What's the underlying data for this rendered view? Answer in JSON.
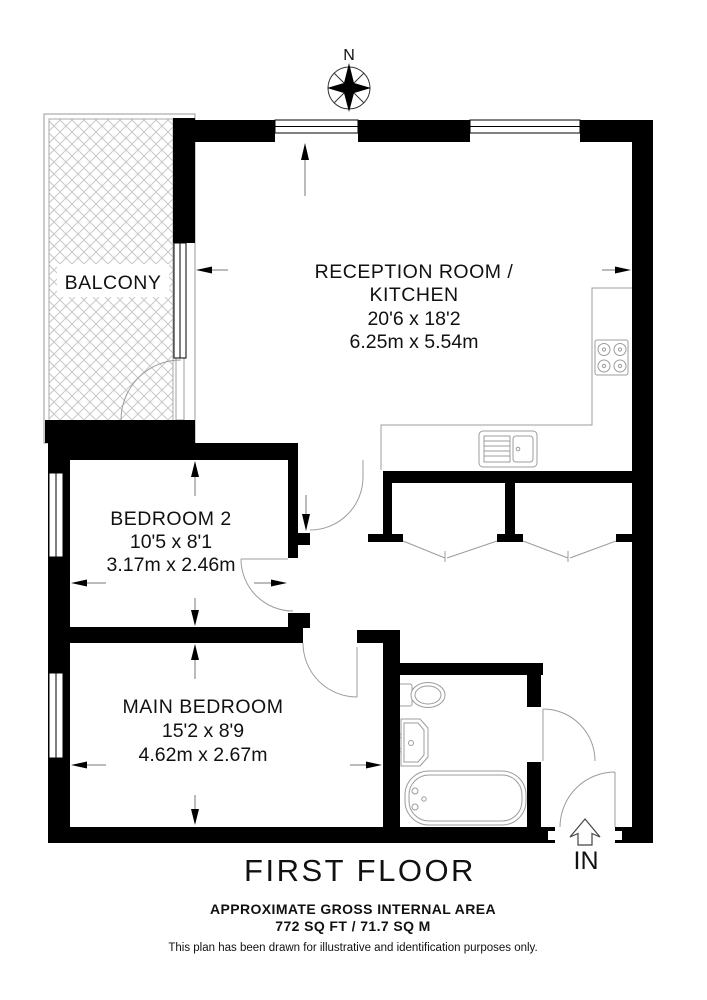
{
  "meta": {
    "floor_label": "FIRST FLOOR",
    "area_label": "APPROXIMATE GROSS INTERNAL AREA",
    "area_value": "772 SQ FT / 71.7 SQ M",
    "disclaimer": "This plan has been drawn for illustrative and identification purposes only.",
    "compass_label": "N",
    "entrance_label": "IN"
  },
  "rooms": {
    "balcony": {
      "name": "BALCONY"
    },
    "reception": {
      "name_line1": "RECEPTION ROOM /",
      "name_line2": "KITCHEN",
      "imperial": "20'6 x 18'2",
      "metric": "6.25m x 5.54m"
    },
    "bedroom2": {
      "name": "BEDROOM 2",
      "imperial": "10'5 x 8'1",
      "metric": "3.17m x 2.46m"
    },
    "main_bedroom": {
      "name": "MAIN BEDROOM",
      "imperial": "15'2 x 8'9",
      "metric": "4.62m x 2.67m"
    }
  },
  "colors": {
    "wall": "#000000",
    "fixture_line": "#9c9c9c",
    "hatch_line": "#c9c9c9",
    "dimension_line": "#777777",
    "text": "#111111"
  }
}
